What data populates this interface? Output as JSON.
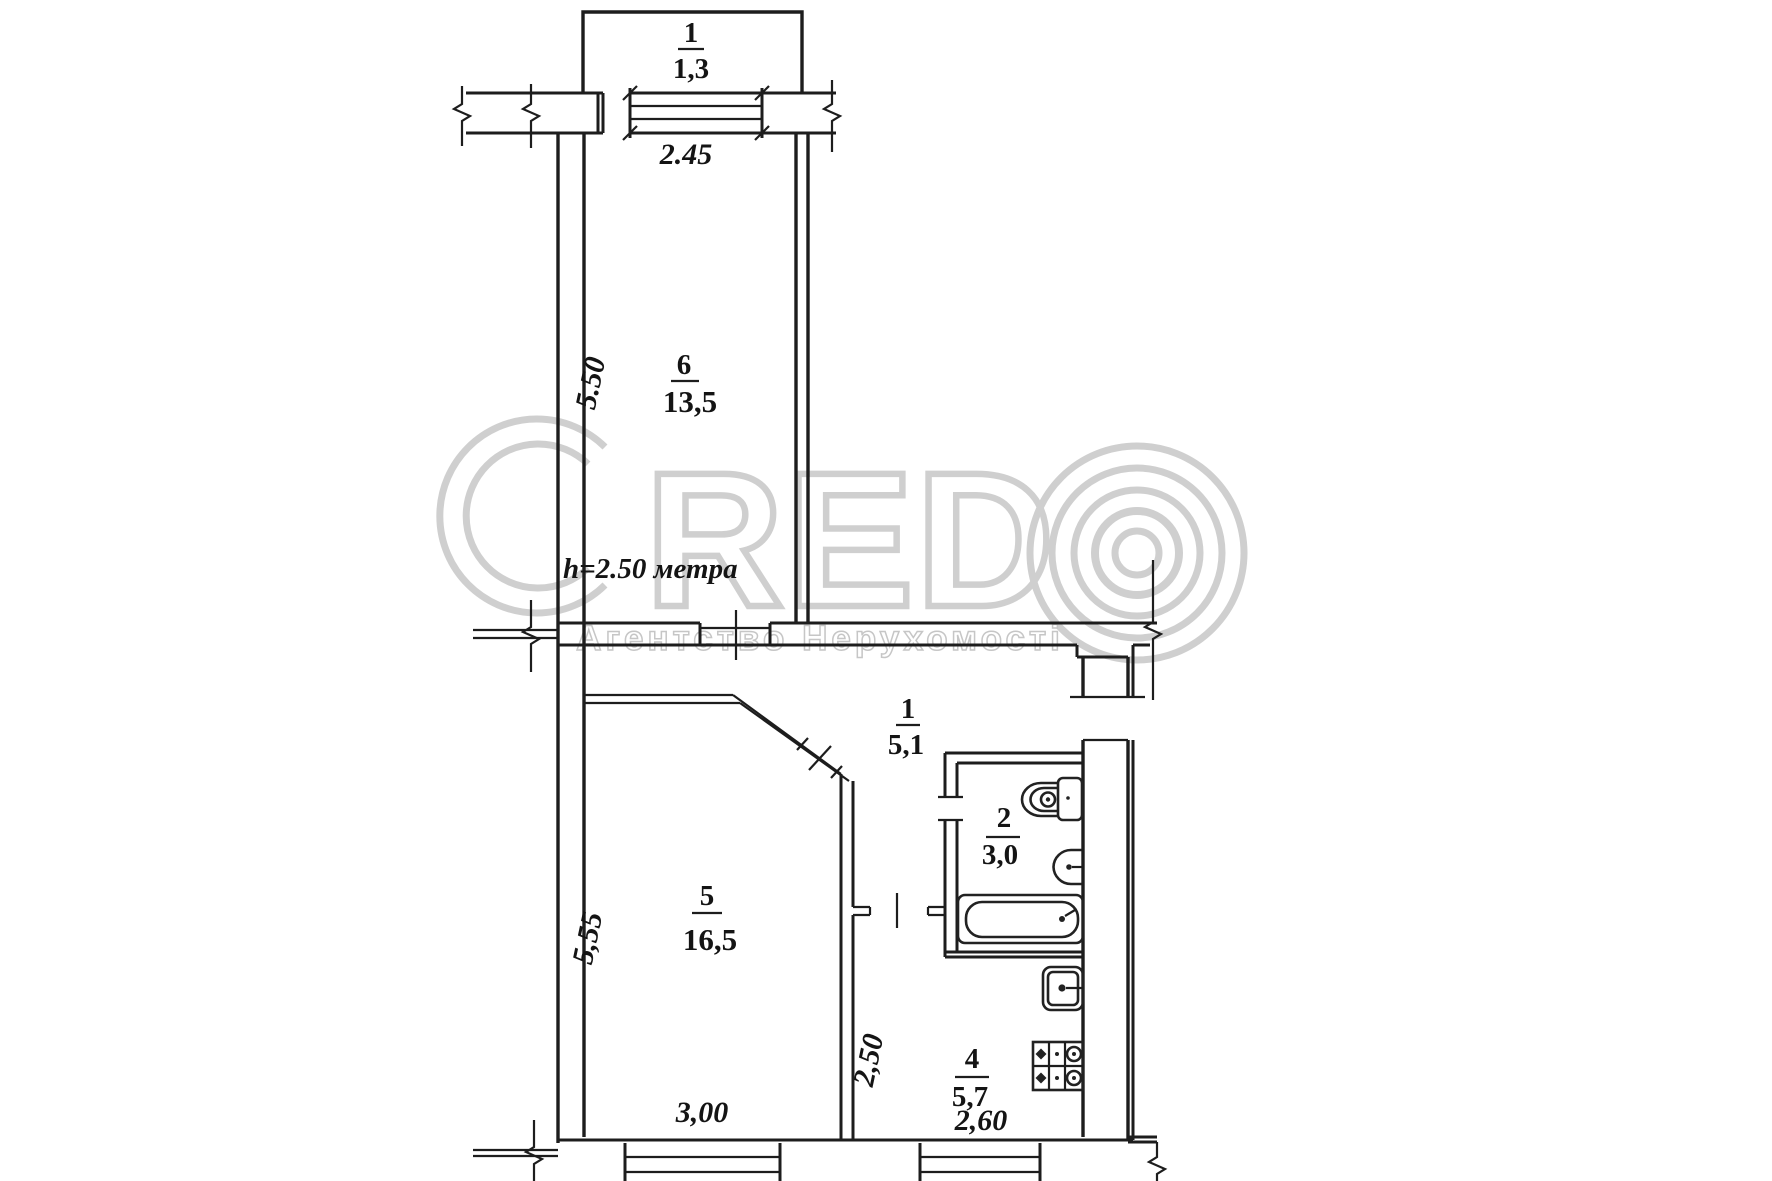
{
  "colors": {
    "line": "#1d1d1d",
    "text": "#141414",
    "watermark": "#cfcfcf"
  },
  "plan": {
    "balcony": {
      "number": "1",
      "area": "1,3"
    },
    "rooms": {
      "hall": {
        "number": "1",
        "area": "5,1"
      },
      "bath": {
        "number": "2",
        "area": "3,0"
      },
      "kitchen": {
        "number": "4",
        "area": "5,7"
      },
      "living": {
        "number": "5",
        "area": "16,5"
      },
      "bedroom": {
        "number": "6",
        "area": "13,5"
      }
    },
    "dims": {
      "balcony_window": "2.45",
      "bedroom_depth": "5.50",
      "living_depth": "5,55",
      "kitchen_depth": "2,50",
      "living_width": "3,00",
      "kitchen_width": "2,60"
    },
    "ceiling_note": "h=2.50 метра"
  },
  "watermark": {
    "letters": "RED",
    "subtitle": "Агентство Нерухомості"
  }
}
